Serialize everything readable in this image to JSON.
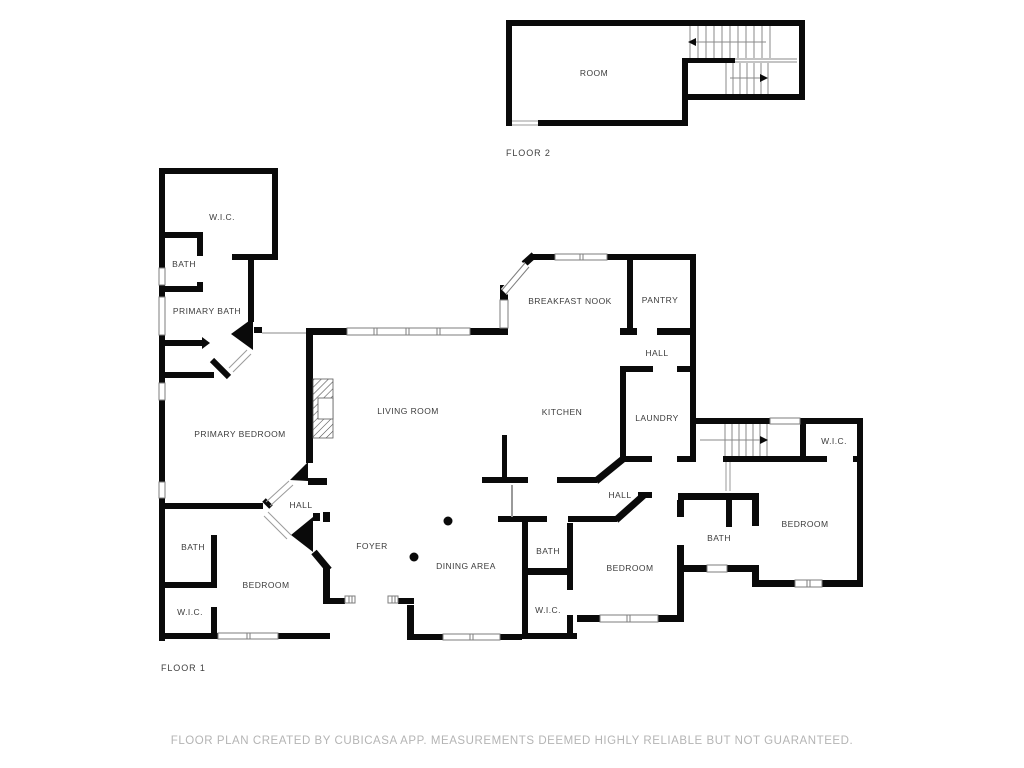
{
  "footer": {
    "disclaimer": "FLOOR PLAN CREATED BY CUBICASA APP. MEASUREMENTS DEEMED HIGHLY RELIABLE BUT NOT GUARANTEED."
  },
  "colors": {
    "wall": "#0a0a0a",
    "label": "#3c3c3c",
    "thin_line": "#8a8a8a",
    "footer_text": "#b4b4b4"
  },
  "floor2": {
    "caption": "FLOOR 2",
    "rooms": [
      {
        "name": "room",
        "label": "ROOM",
        "x": 594,
        "y": 76
      }
    ]
  },
  "floor1": {
    "caption": "FLOOR 1",
    "rooms": [
      {
        "name": "wic-top-left",
        "label": "W.I.C.",
        "x": 222,
        "y": 220
      },
      {
        "name": "bath-top-left",
        "label": "BATH",
        "x": 184,
        "y": 267
      },
      {
        "name": "primary-bath",
        "label": "PRIMARY BATH",
        "x": 207,
        "y": 314
      },
      {
        "name": "breakfast-nook",
        "label": "BREAKFAST NOOK",
        "x": 570,
        "y": 304
      },
      {
        "name": "pantry",
        "label": "PANTRY",
        "x": 660,
        "y": 303
      },
      {
        "name": "hall-pantry",
        "label": "HALL",
        "x": 657,
        "y": 356
      },
      {
        "name": "living-room",
        "label": "LIVING ROOM",
        "x": 408,
        "y": 414
      },
      {
        "name": "kitchen",
        "label": "KITCHEN",
        "x": 562,
        "y": 415
      },
      {
        "name": "laundry",
        "label": "LAUNDRY",
        "x": 657,
        "y": 421
      },
      {
        "name": "primary-bedroom",
        "label": "PRIMARY BEDROOM",
        "x": 240,
        "y": 437
      },
      {
        "name": "wic-right",
        "label": "W.I.C.",
        "x": 834,
        "y": 444
      },
      {
        "name": "hall-right",
        "label": "HALL",
        "x": 620,
        "y": 498
      },
      {
        "name": "hall-left",
        "label": "HALL",
        "x": 301,
        "y": 508
      },
      {
        "name": "bedroom-right",
        "label": "BEDROOM",
        "x": 805,
        "y": 527
      },
      {
        "name": "foyer",
        "label": "FOYER",
        "x": 372,
        "y": 549
      },
      {
        "name": "bath-left",
        "label": "BATH",
        "x": 193,
        "y": 550
      },
      {
        "name": "bath-right",
        "label": "BATH",
        "x": 719,
        "y": 541
      },
      {
        "name": "bath-center",
        "label": "BATH",
        "x": 548,
        "y": 554
      },
      {
        "name": "dining-area",
        "label": "DINING AREA",
        "x": 466,
        "y": 569
      },
      {
        "name": "bedroom-center",
        "label": "BEDROOM",
        "x": 630,
        "y": 571
      },
      {
        "name": "bedroom-left",
        "label": "BEDROOM",
        "x": 266,
        "y": 588
      },
      {
        "name": "wic-center",
        "label": "W.I.C.",
        "x": 548,
        "y": 613
      },
      {
        "name": "wic-left",
        "label": "W.I.C.",
        "x": 190,
        "y": 615
      }
    ]
  }
}
